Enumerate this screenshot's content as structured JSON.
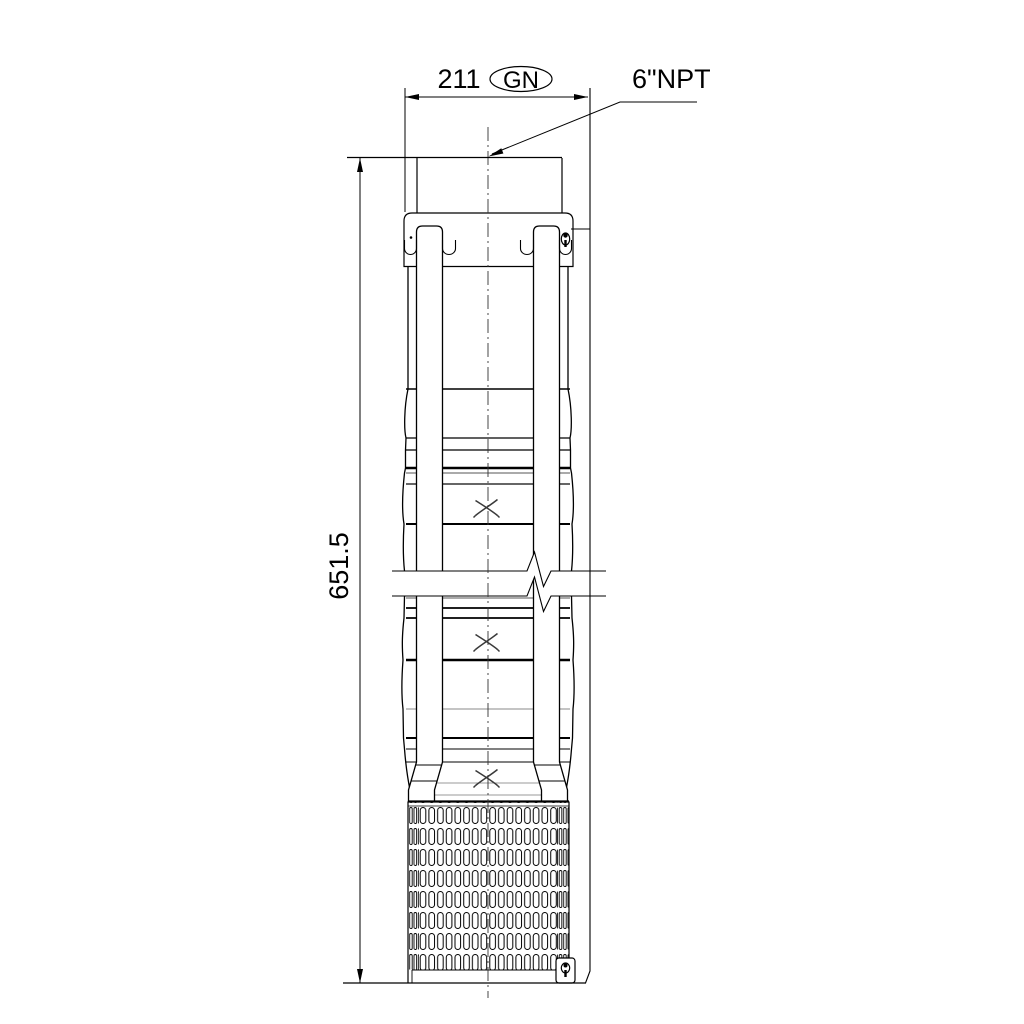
{
  "meta": {
    "background_color": "#ffffff",
    "line_color": "#000000"
  },
  "annotations": {
    "width_dimension": "211",
    "width_variant": "GN",
    "height_dimension": "651.5",
    "connection_label": "6\"NPT"
  }
}
